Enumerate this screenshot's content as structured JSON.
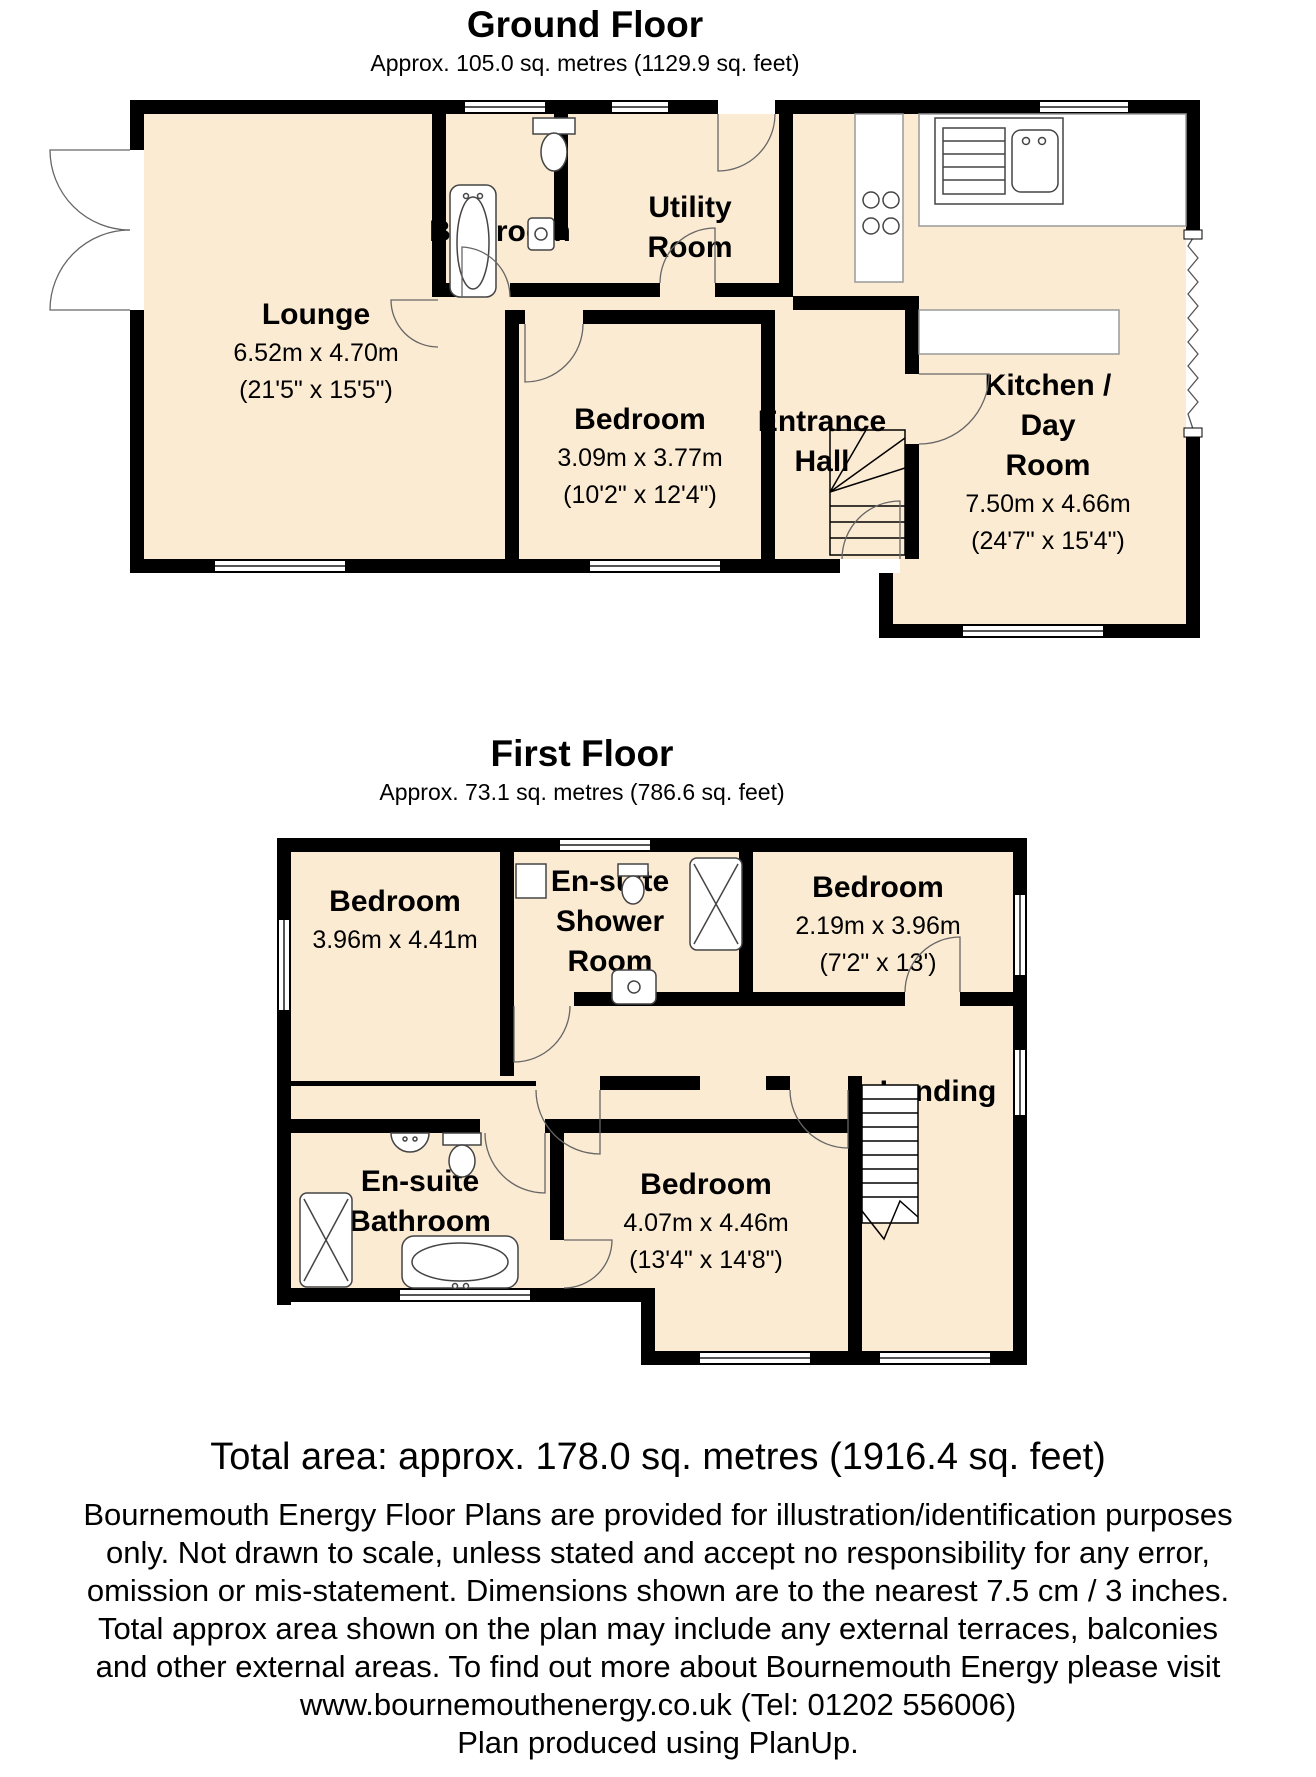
{
  "colors": {
    "floor": "#fcebd3",
    "wall": "#000000",
    "fixture_stroke": "#444444"
  },
  "ground_floor": {
    "title": "Ground Floor",
    "subtitle": "Approx. 105.0 sq. metres (1129.9 sq. feet)",
    "rooms": {
      "lounge": {
        "name": "Lounge",
        "dim_m": "6.52m x 4.70m",
        "dim_ft": "(21'5\" x 15'5\")"
      },
      "bathroom": {
        "name": "Bathroom"
      },
      "utility": {
        "line1": "Utility",
        "line2": "Room"
      },
      "bedroom": {
        "name": "Bedroom",
        "dim_m": "3.09m x 3.77m",
        "dim_ft": "(10'2\" x 12'4\")"
      },
      "hall": {
        "line1": "Entrance",
        "line2": "Hall"
      },
      "kitchen": {
        "line1": "Kitchen /",
        "line2": "Day",
        "line3": "Room",
        "dim_m": "7.50m x 4.66m",
        "dim_ft": "(24'7\" x 15'4\")"
      }
    }
  },
  "first_floor": {
    "title": "First Floor",
    "subtitle": "Approx.  73.1 sq. metres (786.6 sq. feet)",
    "rooms": {
      "bedroom1": {
        "name": "Bedroom",
        "dim_m": "3.96m x 4.41m",
        "dim_ft": "(13' x 14'6\")"
      },
      "shower": {
        "line1": "En-suite",
        "line2": "Shower",
        "line3": "Room"
      },
      "bedroom2": {
        "name": "Bedroom",
        "dim_m": "2.19m x 3.96m",
        "dim_ft": "(7'2\" x 13')"
      },
      "landing": {
        "name": "Landing"
      },
      "bathroom": {
        "line1": "En-suite",
        "line2": "Bathroom"
      },
      "bedroom3": {
        "name": "Bedroom",
        "dim_m": "4.07m x 4.46m",
        "dim_ft": "(13'4\" x 14'8\")"
      }
    }
  },
  "total_area": "Total area: approx. 178.0 sq. metres (1916.4 sq. feet)",
  "disclaimer": [
    "Bournemouth Energy Floor Plans are provided for illustration/identification purposes",
    "only. Not drawn to scale, unless stated and accept no responsibility for any error,",
    "omission or mis-statement. Dimensions shown are to the nearest 7.5 cm / 3 inches.",
    "Total approx area shown on the plan may include any external terraces, balconies",
    "and other external areas. To find out more about Bournemouth Energy please visit",
    "www.bournemouthenergy.co.uk (Tel: 01202 556006)",
    "Plan produced using PlanUp."
  ]
}
